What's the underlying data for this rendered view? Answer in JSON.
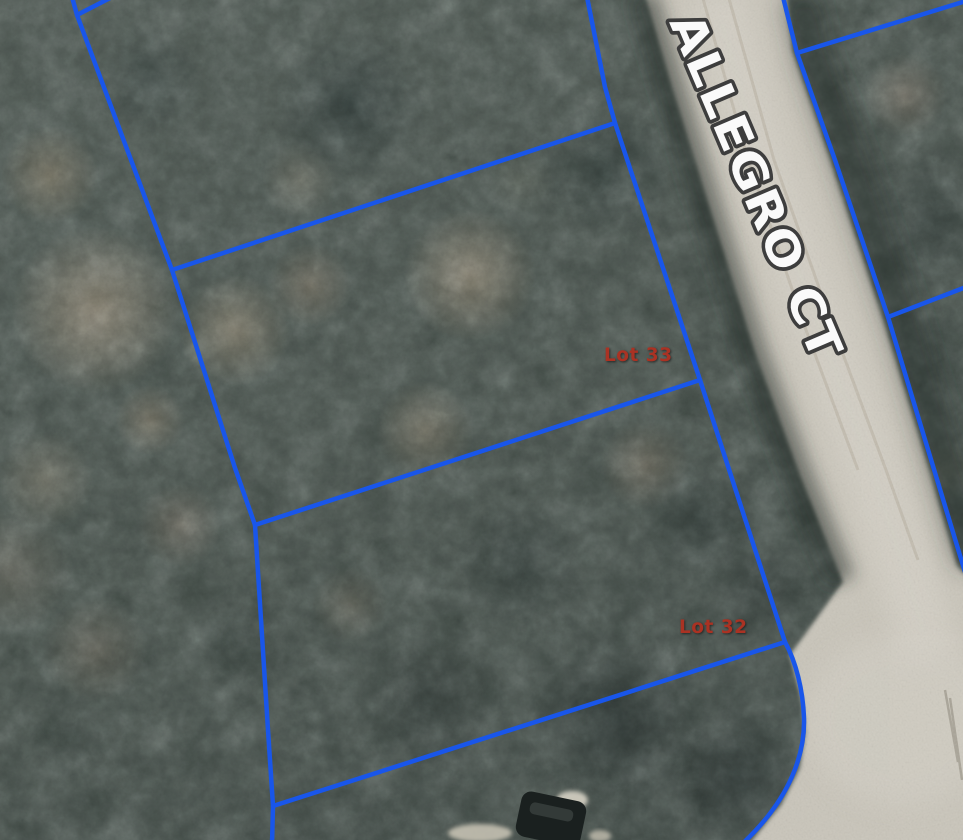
{
  "map": {
    "street_label": "ALLEGRO CT",
    "lot_33_label": "Lot 33",
    "lot_32_label": "Lot 32",
    "colors": {
      "parcel_line": "#1956ea",
      "lot_label_text": "#aa3223",
      "street_label_fill": "#fafafa",
      "street_label_outline": "#3d3d3d",
      "road_surface": "#c9c5ba"
    }
  }
}
